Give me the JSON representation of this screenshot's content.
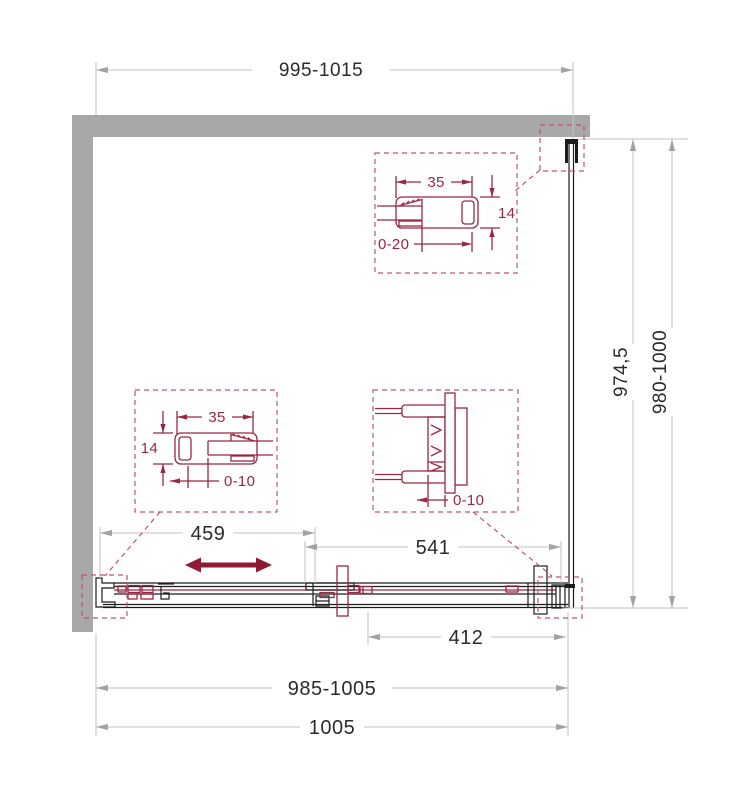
{
  "colors": {
    "wall": "#a8a8a8",
    "dim_line": "#c2c2c2",
    "dim_arrow": "#a3a3a3",
    "dim_text": "#2b2b2b",
    "line_black": "#1c1c1c",
    "detail_red": "#9a2742",
    "dash_red": "#c0546e",
    "arrow_red": "#8e1b33"
  },
  "drawing": {
    "dims": {
      "top_width": "995-1015",
      "right_inner": "974,5",
      "right_outer": "980-1000",
      "door_opening": "459",
      "fixed_width": "541",
      "overlap": "412",
      "bottom_adjust": "985-1005",
      "bottom_total": "1005"
    },
    "detail_top_right": {
      "width": "35",
      "height": "14",
      "depth": "0-20"
    },
    "detail_mid_left": {
      "width": "35",
      "height": "14",
      "depth": "0-10"
    },
    "detail_mid_right": {
      "depth": "0-10"
    }
  }
}
